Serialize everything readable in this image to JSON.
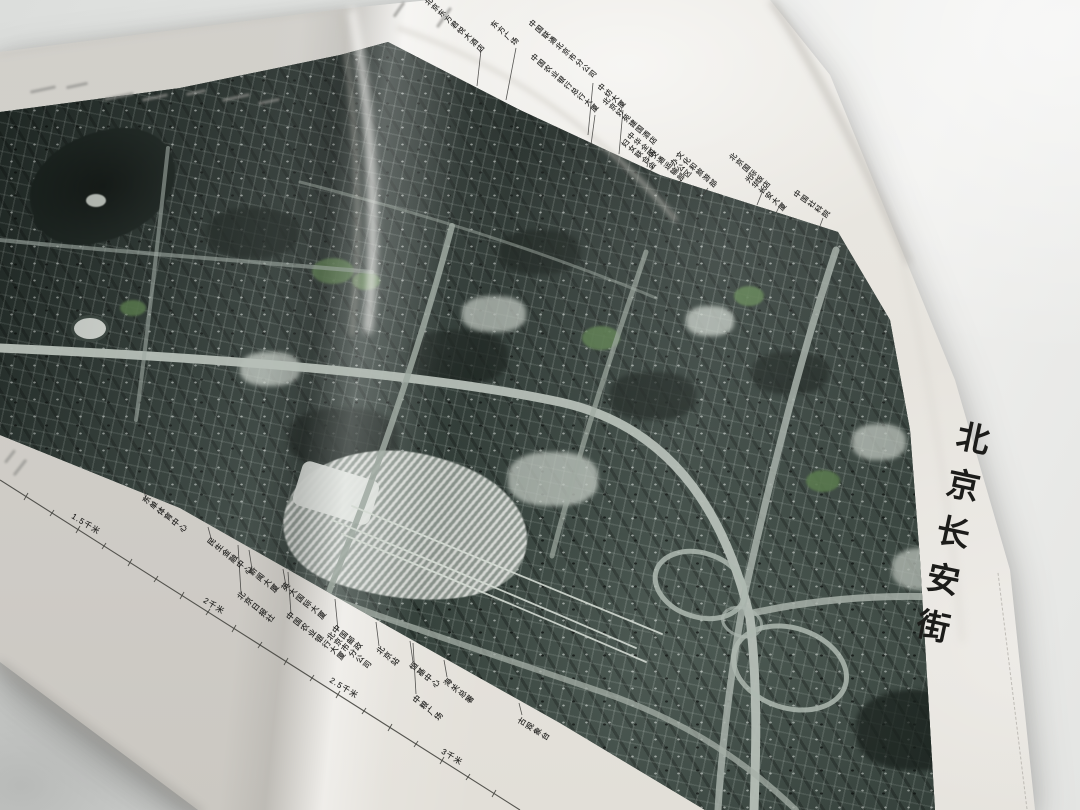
{
  "book_title": "北京长安街",
  "map_top_labels": [
    "北京东方君悦大酒店",
    "东方广场",
    "中国联通北京市分公司",
    "中国农业银行总行大厦",
    "中纺大厦",
    "北京好苑建国酒店",
    "中华全国\n妇女联合会",
    "交通运输部",
    "文化和旅游部\n办公区",
    "北京国际饭店",
    "光华长安大厦",
    "中国社科院"
  ],
  "map_bottom_labels": [
    "东单体育中心",
    "民生金融中心",
    "新闻大厦",
    "北京日报社",
    "英大国际大厦",
    "中国农业银行大厦",
    "中国邮政\n北京市分公司",
    "北京站",
    "恒基中心",
    "海关总署",
    "中粮广场",
    "古观象台"
  ],
  "scale_labels": [
    "1.5千米",
    "2千米",
    "2.5千米",
    "3千米"
  ]
}
